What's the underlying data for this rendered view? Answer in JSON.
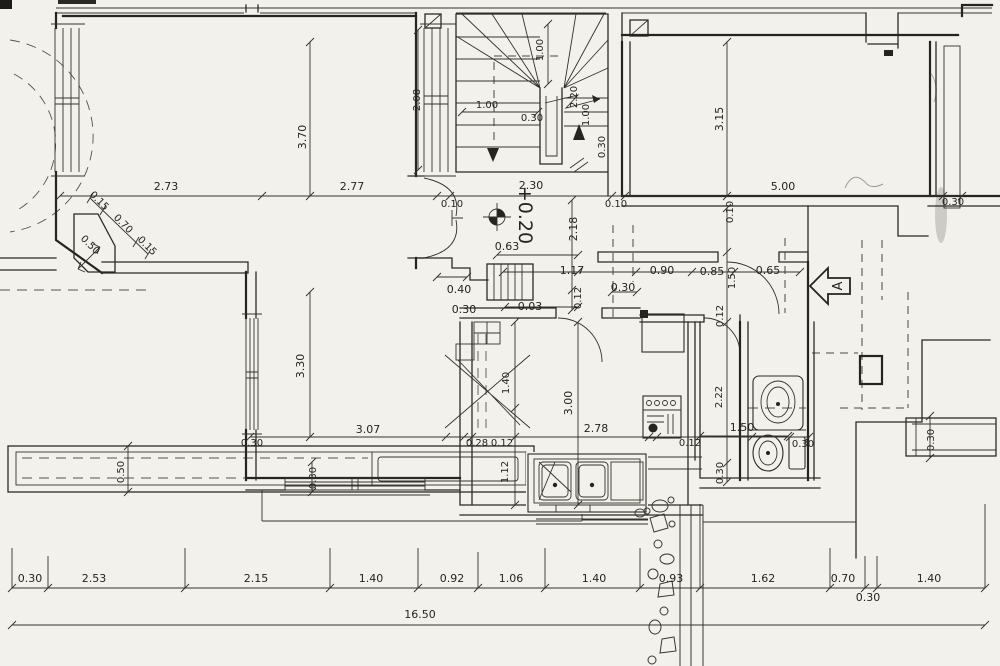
{
  "colors": {
    "paper": "#f3f1eb",
    "ink": "#26241f"
  },
  "plan": {
    "level_marker": "+0.20",
    "section_label": "A",
    "total_length": "16.50",
    "dims_top_chain": [
      "2.73",
      "2.77",
      "0.10",
      "2.30",
      "0.10",
      "5.00",
      "0.30"
    ],
    "dims_fireplace": [
      "0.15",
      "0.70",
      "0.15",
      "0.50"
    ],
    "dims_left": [
      "3.70",
      "3.30",
      "3.07",
      "0.30",
      "0.30",
      "0.50"
    ],
    "dims_stairs": [
      "2.08",
      "1.00",
      "1.00",
      "0.30",
      "2.20",
      "1.00",
      "0.30"
    ],
    "dims_right_room": [
      "3.15",
      "0.10"
    ],
    "dims_hall": [
      "2.18",
      "0.63",
      "1.17",
      "0.90",
      "0.85",
      "0.65",
      "0.40",
      "0.30",
      "0.03",
      "0.30",
      "0.12",
      "1.50",
      "0.12"
    ],
    "dims_kitchen": [
      "1.40",
      "3.00",
      "2.78",
      "0.28",
      "0.12",
      "0.12",
      "1.12"
    ],
    "dims_bath": [
      "2.22",
      "1.50",
      "0.30",
      "0.30",
      "0.30"
    ],
    "dims_bottom_chain": [
      "0.30",
      "2.53",
      "2.15",
      "1.40",
      "0.92",
      "1.06",
      "1.40",
      "0.93",
      "1.62",
      "0.70",
      "0.30",
      "1.40"
    ]
  }
}
